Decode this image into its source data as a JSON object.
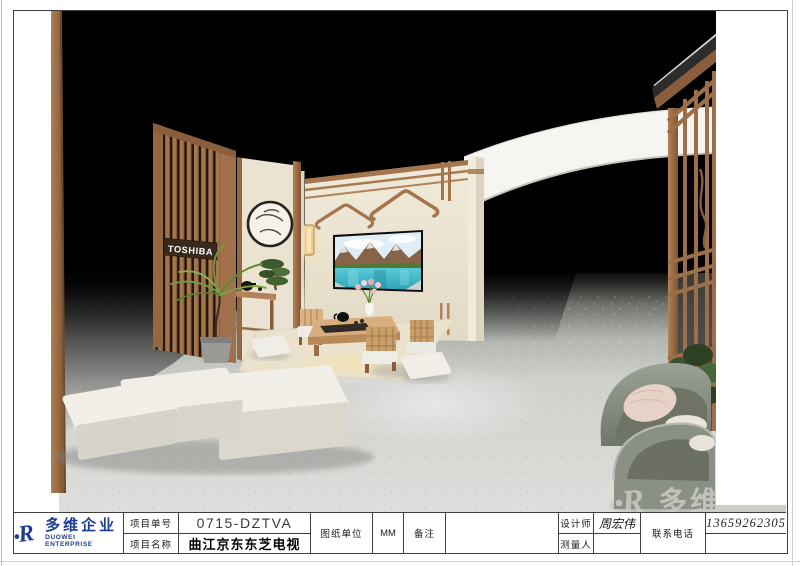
{
  "logo": {
    "monogram": "R",
    "company_cn": "多维企业",
    "company_en": "DUOWEI ENTERPRISE",
    "blue": "#1d3e92"
  },
  "watermark": {
    "monogram": "R",
    "text": "多维企",
    "color": "#cfccc5"
  },
  "scene": {
    "toshiba_sign": "TOSHIBA",
    "colors": {
      "backdrop": "#000000",
      "wood": "#a5754d",
      "wall_beige": "#ece5d4",
      "floor": "#d8d9d5",
      "canopy": "#f6f5f1",
      "chair_sage": "#8e9287",
      "lake": "#3cc0d0"
    }
  },
  "title_block": {
    "project_no_label": "项目单号",
    "project_no": "0715-DZTVA",
    "project_name_label": "项目名称",
    "project_name": "曲江京东东芝电视",
    "unit_label": "图纸单位",
    "unit_value": "MM",
    "remark_label": "备注",
    "remark_value": "",
    "designer_label": "设计师",
    "designer_value": "周宏伟",
    "surveyor_label": "测量人",
    "surveyor_value": "",
    "phone_label": "联系电话",
    "phone_value": "13659262305"
  }
}
